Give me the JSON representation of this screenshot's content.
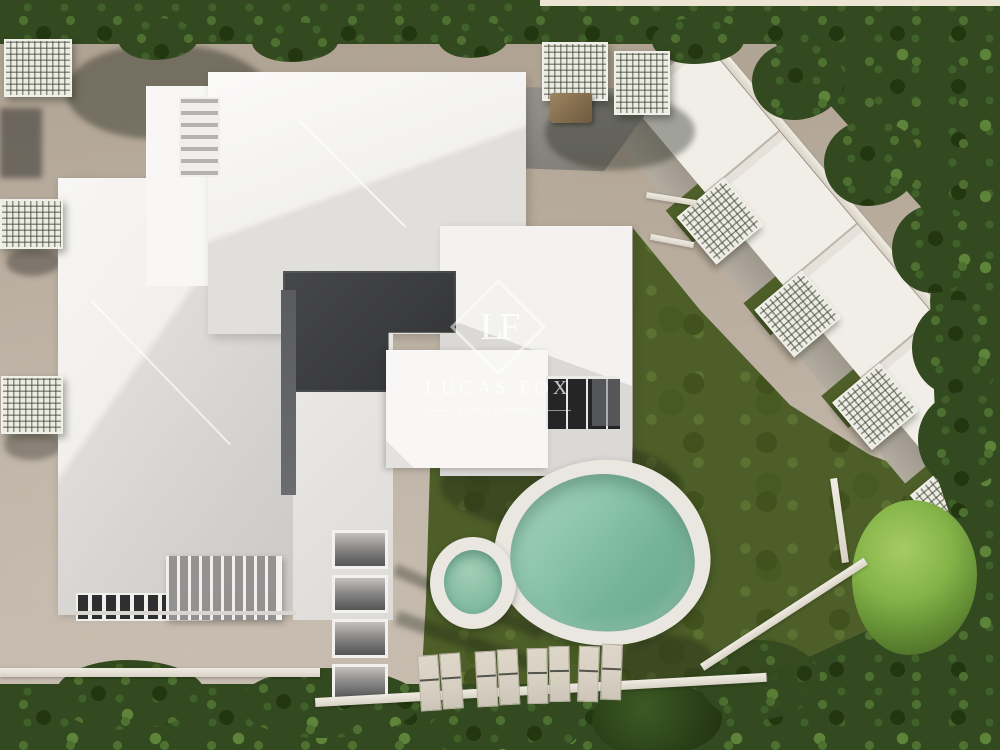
{
  "watermark": {
    "monogram": "LF",
    "brand": "LUCAS FOX",
    "tagline": "a DILS company"
  },
  "scene": {
    "description": "Aerial 3D render of a residential development: white hip-roofed main building, beige terraces with lattice pergolas, diagonal row of terraced units, landscaped lawn with free-form pool and round kids pool, sun loungers, tree borders",
    "palette": {
      "roof_white": "#f4f3f1",
      "roof_shadow": "#d4d2cf",
      "terrace_beige": "#b7ab9c",
      "lawn_green": "#4d5e28",
      "tree_green": "#33491f",
      "bright_tree": "#8ab648",
      "pool_water": "#7fbc9f",
      "pool_deck": "#eae7e1",
      "lounger_cream": "#d9d2c4",
      "courtyard_dark": "#3e3f41"
    },
    "counts": {
      "sun_loungers": 8,
      "pergolas": 9,
      "pools": 2,
      "terraced_units": 5
    }
  }
}
